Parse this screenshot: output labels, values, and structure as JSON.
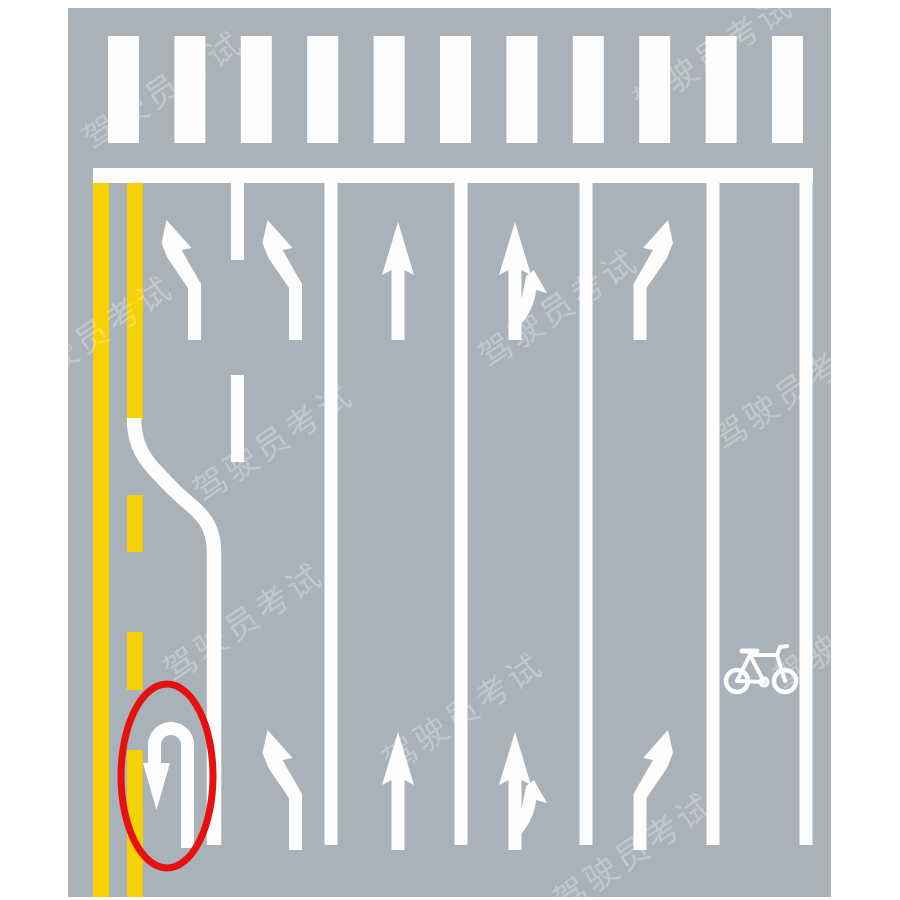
{
  "page": {
    "type": "road-marking-diagram",
    "background": "#ffffff",
    "description": "Intersection approach road markings with highlighted U-turn arrow"
  },
  "road": {
    "surface_color": "#a9b2b9",
    "marking_colors": {
      "white": "#fdfdfd",
      "yellow": "#f6d203",
      "highlight": "#e6100f"
    },
    "crosswalk": {
      "stripes": 11
    },
    "stop_line": true,
    "center_line": "double-yellow-with-uturn-opening",
    "lanes": [
      {
        "name": "u-turn-pocket",
        "marking": "u-turn-arrow",
        "highlighted": true
      },
      {
        "name": "lane-1",
        "marking": "left-turn-arrow"
      },
      {
        "name": "lane-2",
        "marking": "left-turn-arrow"
      },
      {
        "name": "lane-3",
        "marking": "straight-arrow"
      },
      {
        "name": "lane-4",
        "marking": "straight-right-arrow"
      },
      {
        "name": "lane-5",
        "marking": "right-turn-arrow"
      },
      {
        "name": "bicycle-lane",
        "marking": "bicycle-symbol"
      }
    ],
    "arrow_rows": {
      "top": [
        "left-turn",
        "left-turn",
        "straight",
        "straight-right",
        "right-turn"
      ],
      "bottom": [
        "u-turn",
        "left-turn",
        "straight",
        "straight-right",
        "right-turn"
      ]
    },
    "highlight": {
      "shape": "ellipse",
      "target": "u-turn-arrow"
    }
  },
  "watermark": {
    "text": "驾驶员考试",
    "color": "rgba(255,255,255,0.28)"
  }
}
